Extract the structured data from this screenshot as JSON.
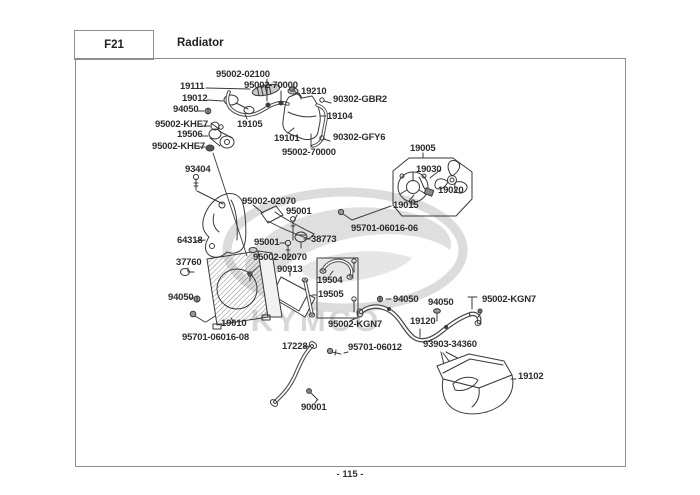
{
  "header": {
    "page_code": "F21",
    "title": "Radiator"
  },
  "footer": {
    "page_number": "- 115 -"
  },
  "watermark": {
    "text": "KYMCO"
  },
  "labels": {
    "p95002_02100": "95002-02100",
    "p19111": "19111",
    "p95002_70000_a": "95002-70000",
    "p19210": "19210",
    "p90302_GBR2": "90302-GBR2",
    "p19012": "19012",
    "p94050_a": "94050",
    "p95002_KHE7_a": "95002-KHE7",
    "p19105": "19105",
    "p19104": "19104",
    "p19506": "19506",
    "p19101": "19101",
    "p90302_GFY6": "90302-GFY6",
    "p95002_KHE7_b": "95002-KHE7",
    "p95002_70000_b": "95002-70000",
    "p19005": "19005",
    "p93404": "93404",
    "p19030": "19030",
    "p19020": "19020",
    "p19015": "19015",
    "p95002_02070_a": "95002-02070",
    "p95001_a": "95001",
    "p95701_06016_06": "95701-06016-06",
    "p64318": "64318",
    "p95001_b": "95001",
    "p38773": "38773",
    "p95002_02070_b": "95002-02070",
    "p37760": "37760",
    "p90913": "90913",
    "p19504": "19504",
    "p19505": "19505",
    "p94050_b": "94050",
    "p94050_c": "94050",
    "p94050_d": "94050",
    "p95002_KGN7_a": "95002-KGN7",
    "p19010": "19010",
    "p19120": "19120",
    "p95002_KGN7_b": "95002-KGN7",
    "p95701_06016_08": "95701-06016-08",
    "p17228": "17228",
    "p95701_06012": "95701-06012",
    "p93903_34360": "93903-34360",
    "p19102": "19102",
    "p90001": "90001"
  }
}
